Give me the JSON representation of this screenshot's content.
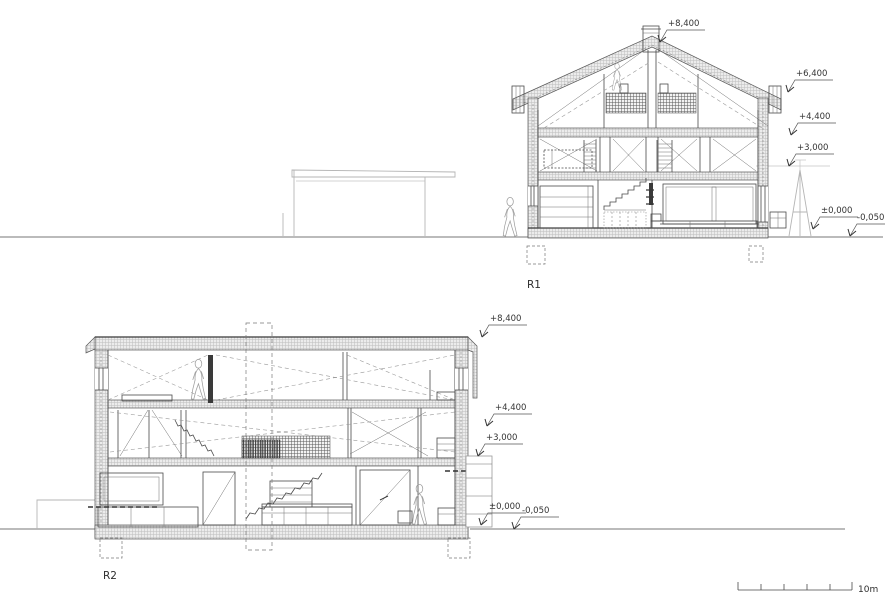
{
  "sections": {
    "r1": {
      "label": "R1",
      "levels": {
        "ridge": "+8,400",
        "eave": "+6,400",
        "upper": "+4,400",
        "mid": "+3,000",
        "zero": "±0,000",
        "ground": "-0,050"
      }
    },
    "r2": {
      "label": "R2",
      "levels": {
        "parapet": "+8,400",
        "upper": "+4,400",
        "mid": "+3,000",
        "zero": "±0,000",
        "ground": "-0,050"
      }
    }
  },
  "scale_bar": {
    "label": "10m"
  },
  "colors": {
    "line": "#4a4a4a",
    "light_line": "#b5b5b5",
    "hatch_fill": "#ececec",
    "hatch_line": "#bdbdbd",
    "dash_line": "#999999",
    "text": "#333333"
  }
}
